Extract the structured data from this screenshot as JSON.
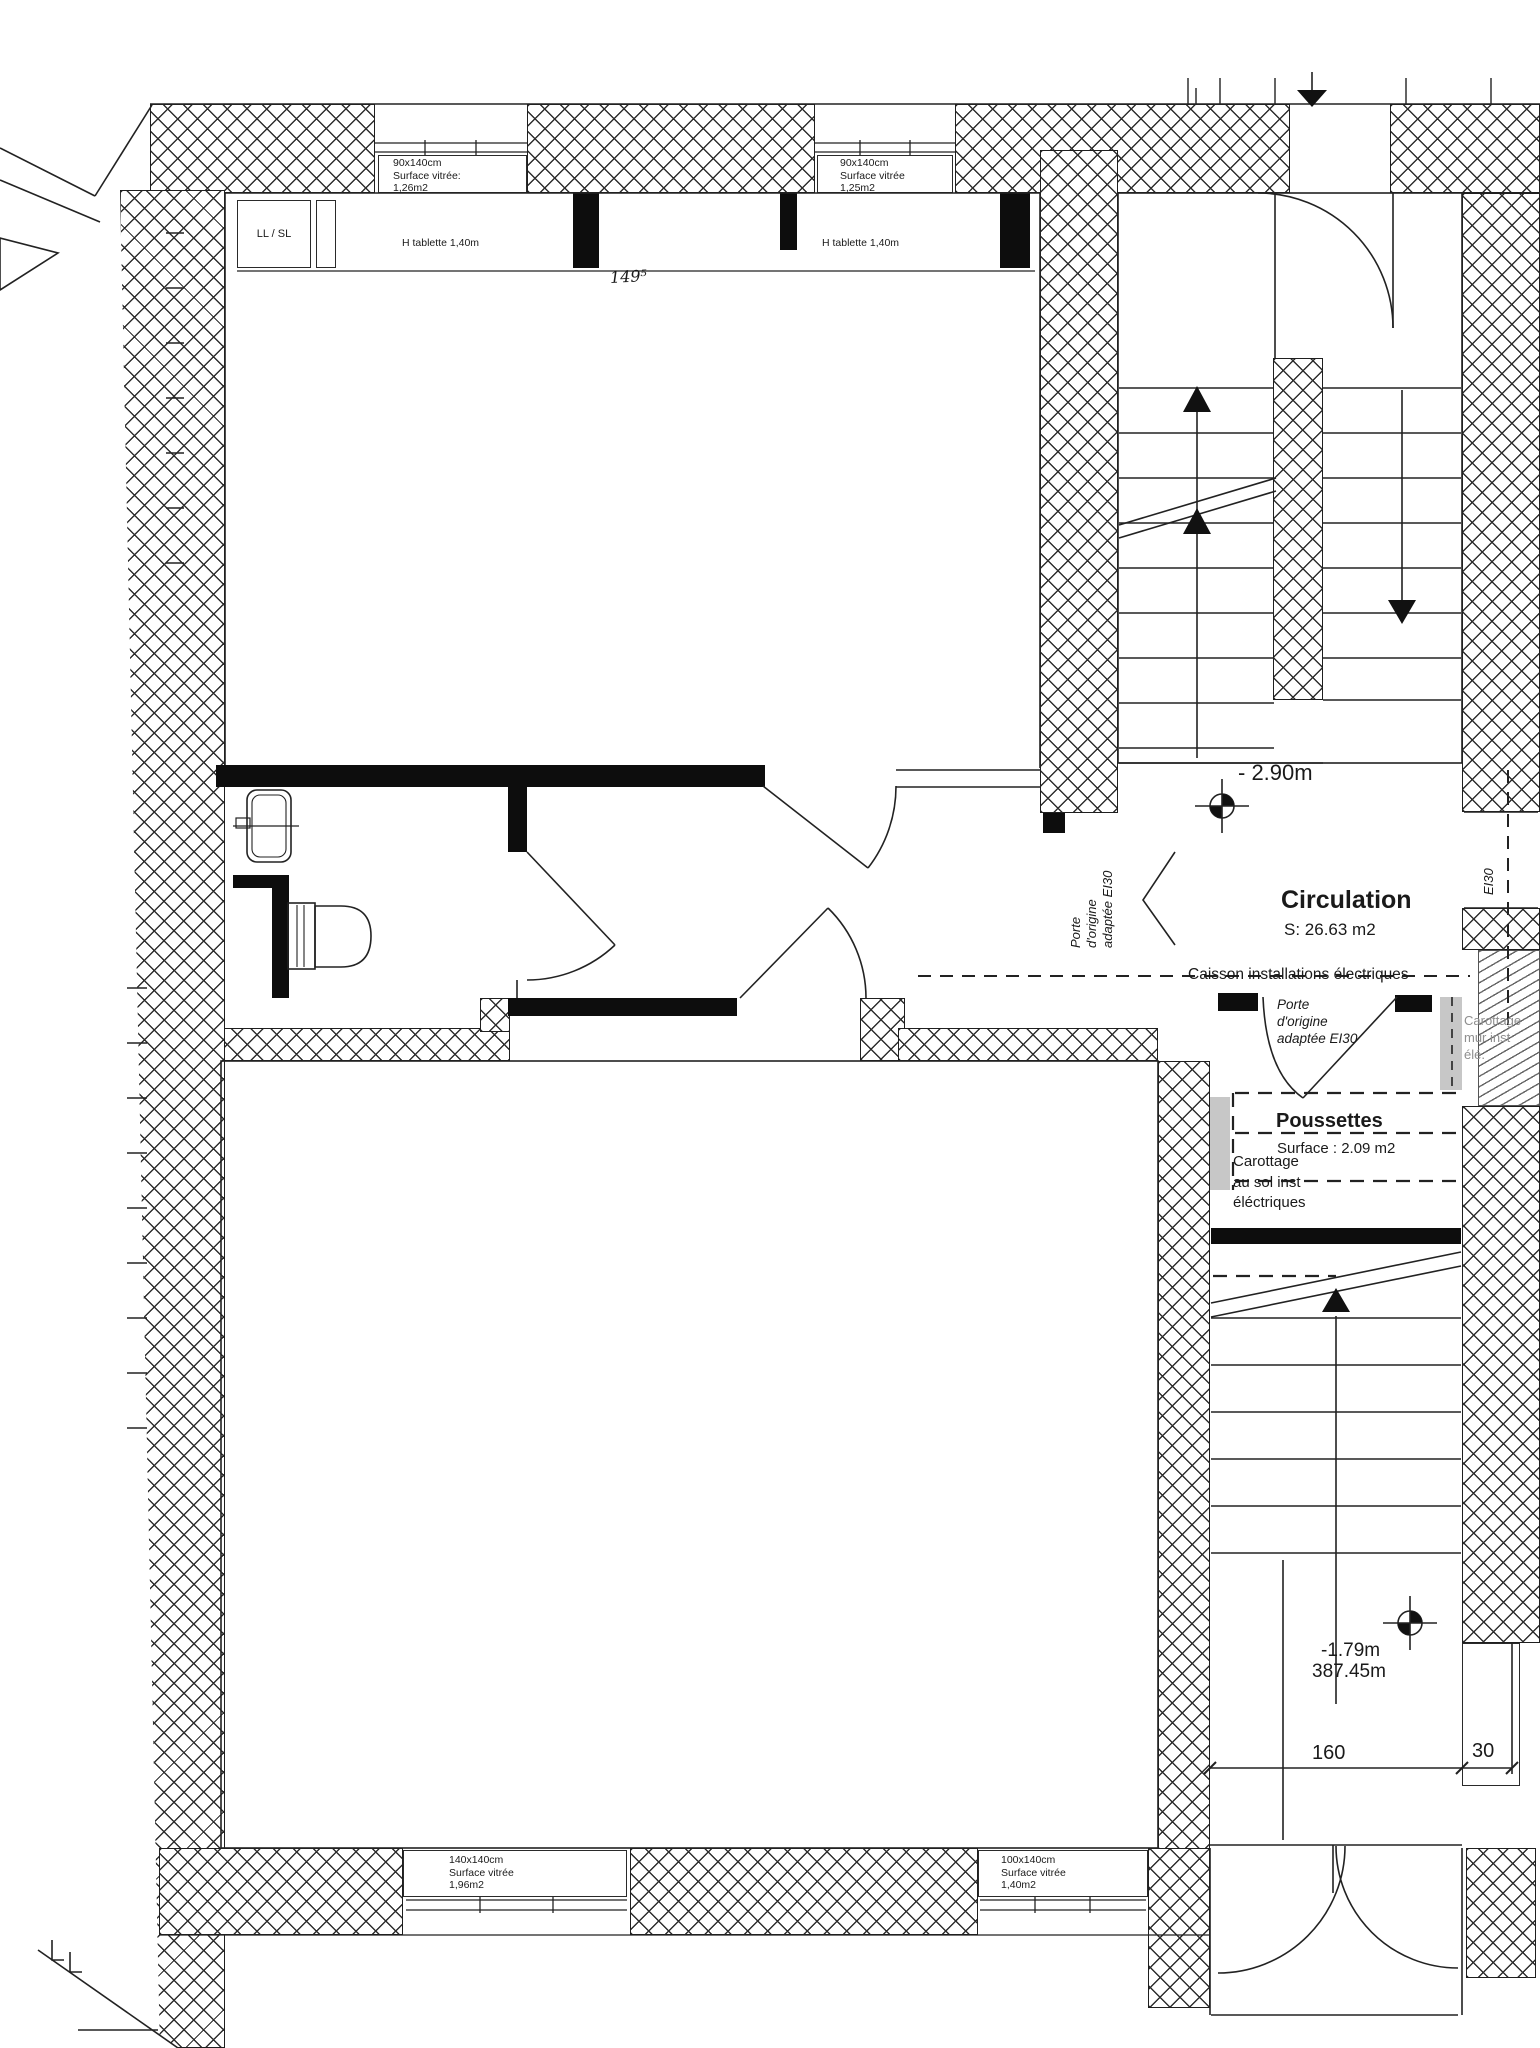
{
  "windows": [
    {
      "size": "90x140cm",
      "glass": "Surface vitrée:",
      "area": "1,26m2"
    },
    {
      "size": "90x140cm",
      "glass": "Surface vitrée",
      "area": "1,25m2"
    },
    {
      "size": "140x140cm",
      "glass": "Surface vitrée",
      "area": "1,96m2"
    },
    {
      "size": "100x140cm",
      "glass": "Surface vitrée",
      "area": "1,40m2"
    }
  ],
  "shelves": {
    "tablette1": "H tablette 1,40m",
    "tablette2": "H tablette 1,40m"
  },
  "appliance": "LL / SL",
  "dimension_149": "149⁵",
  "rooms": {
    "circulation": {
      "name": "Circulation",
      "area": "S: 26.63 m2"
    },
    "poussettes": {
      "name": "Poussettes",
      "area": "Surface : 2.09 m2"
    }
  },
  "levels": {
    "upper": "- 2.90m",
    "entry": "-1.79m",
    "altitude": "387.45m"
  },
  "dimensions": {
    "door_width": "160",
    "wall_width": "30"
  },
  "doors": {
    "ei30": "EI30",
    "porte_origine_1": {
      "l1": "Porte",
      "l2": "d'origine",
      "l3": "adaptée EI30"
    },
    "porte_origine_2": {
      "l1": "Porte",
      "l2": "d'origine",
      "l3": "adaptée EI30"
    }
  },
  "notes": {
    "caisson": "Caisson installations électriques",
    "carottage_mur": {
      "l1": "Carottage",
      "l2": "mur inst",
      "l3": "élé."
    },
    "carottage_sol": {
      "l1": "Carottage",
      "l2": "au sol inst",
      "l3": "éléctriques"
    }
  }
}
